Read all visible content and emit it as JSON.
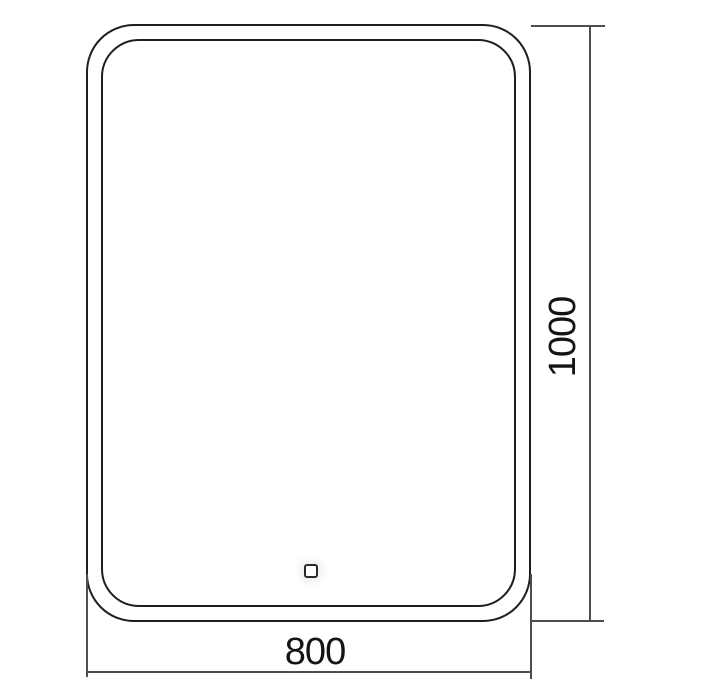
{
  "drawing": {
    "subject": "mirror-front-view-technical-drawing",
    "width_dimension": {
      "value": "800"
    },
    "height_dimension": {
      "value": "1000"
    },
    "features": {
      "touch_sensor": "touch-sensor-square"
    },
    "colors": {
      "background": "#ffffff",
      "outline": "#1f1f1f",
      "dimension_line": "#4d4d4d",
      "label_text": "#141414"
    }
  }
}
